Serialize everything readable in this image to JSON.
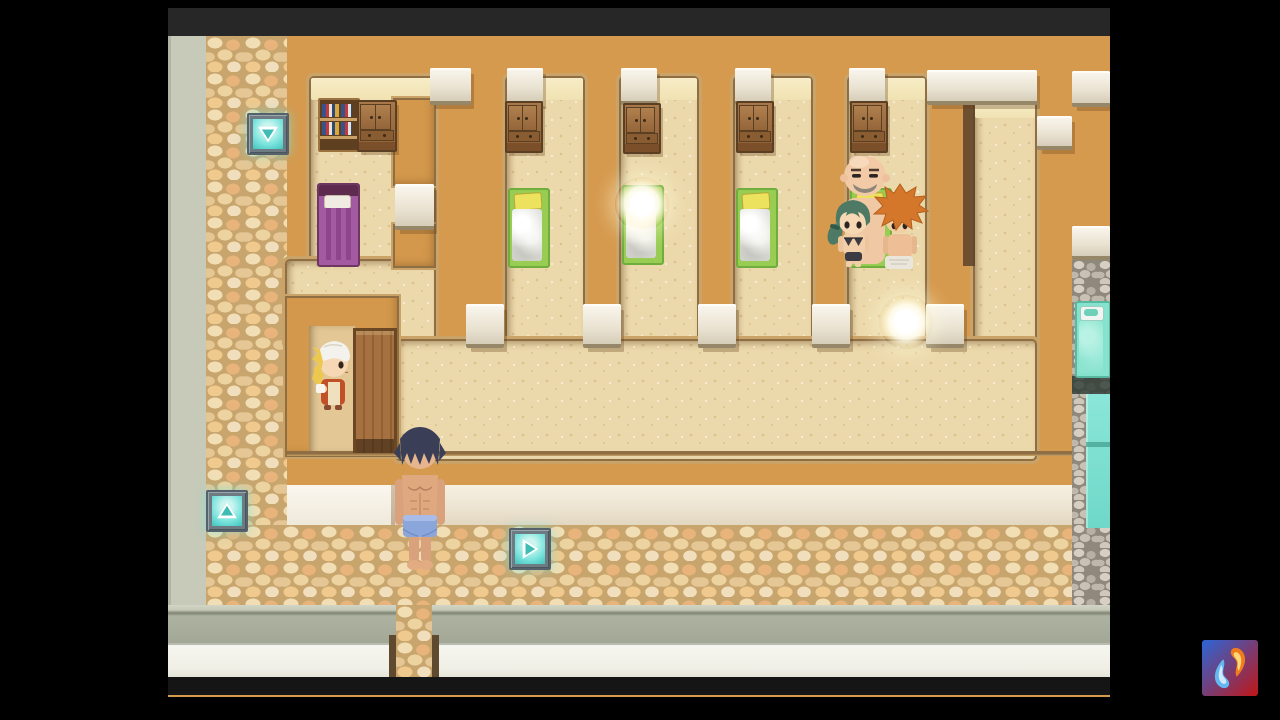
{
  "meta": {
    "style": "top-down pixel RPG scene",
    "scene_name": "dormitory-bathhouse interior",
    "visible_text": "none"
  },
  "frame": {
    "bg": "#000000",
    "game_x": 168,
    "game_y": 8,
    "game_w": 942,
    "game_h": 689,
    "top_bar_h": 28,
    "top_bar_color": "#272727"
  },
  "palette": {
    "wall": "#d69a4e",
    "floor": "#ecd9ab",
    "floor_lit": "#f4e8bf",
    "trim_dark": "#8f6e44",
    "trim_light": "#c9a368",
    "cream_band": "#ece3d1",
    "gray_wall": "#a3a795",
    "white_band": "#f2f2ea",
    "outer_strip": "#c7cab8",
    "water": "#7de0d2",
    "teleport_glow": "#7ce4dd",
    "dark_bottom": "#151515"
  },
  "layers": {
    "outer_strip": [
      0,
      0,
      38,
      569
    ],
    "cobble_dark": [
      38,
      0,
      20,
      566
    ],
    "cobble_path": [
      38,
      0,
      81,
      492
    ],
    "cobble_bottom": [
      38,
      489,
      904,
      80
    ],
    "floors": [
      {
        "name": "stall-1-floor",
        "r": [
          143,
          42,
          123,
          265
        ]
      },
      {
        "name": "stall-2-floor",
        "r": [
          339,
          42,
          76,
          265
        ]
      },
      {
        "name": "stall-3-floor",
        "r": [
          453,
          42,
          76,
          265
        ]
      },
      {
        "name": "stall-4-floor",
        "r": [
          567,
          42,
          76,
          265
        ]
      },
      {
        "name": "stall-5-floor",
        "r": [
          681,
          42,
          76,
          265
        ]
      },
      {
        "name": "right-corridor-floor",
        "r": [
          807,
          67,
          60,
          354
        ]
      },
      {
        "name": "hall-upper-left-floor",
        "r": [
          119,
          225,
          147,
          84
        ]
      },
      {
        "name": "main-hall-floor",
        "r": [
          229,
          305,
          638,
          118
        ]
      }
    ],
    "lit_strips": [
      [
        143,
        42,
        123,
        22
      ],
      [
        339,
        42,
        76,
        22
      ],
      [
        453,
        42,
        76,
        22
      ],
      [
        567,
        42,
        76,
        22
      ],
      [
        681,
        42,
        76,
        22
      ],
      [
        807,
        67,
        60,
        15
      ]
    ],
    "walls": [
      {
        "name": "stall1-pillar",
        "r": [
          227,
          64,
          39,
          84
        ]
      },
      {
        "name": "stall1-pillar-foot",
        "r": [
          227,
          190,
          39,
          40
        ]
      },
      {
        "name": "npc-alcove-wall",
        "r": [
          119,
          262,
          110,
          157
        ]
      }
    ],
    "shadow_strip": [
      795,
      64,
      12,
      166
    ],
    "alcove_floor": [
      141,
      290,
      46,
      127
    ],
    "caps": [
      [
        262,
        32,
        41,
        33
      ],
      [
        339,
        32,
        36,
        33
      ],
      [
        453,
        32,
        36,
        33
      ],
      [
        567,
        32,
        36,
        33
      ],
      [
        681,
        32,
        36,
        33
      ],
      [
        759,
        34,
        110,
        31
      ],
      [
        904,
        35,
        38,
        32
      ],
      [
        227,
        148,
        39,
        42
      ],
      [
        869,
        80,
        35,
        30
      ],
      [
        904,
        190,
        38,
        30
      ],
      [
        298,
        268,
        38,
        40
      ],
      [
        415,
        268,
        38,
        40
      ],
      [
        530,
        268,
        38,
        40
      ],
      [
        644,
        268,
        38,
        40
      ],
      [
        758,
        268,
        38,
        40
      ]
    ],
    "band_trim": [
      119,
      415,
      785,
      5
    ],
    "cream_band": [
      119,
      449,
      785,
      40
    ],
    "cream_cap": [
      119,
      449,
      104,
      40
    ],
    "gray_band": [
      0,
      569,
      942,
      38
    ],
    "white_band": [
      0,
      607,
      942,
      34
    ],
    "dark_strip": [
      0,
      641,
      942,
      18
    ],
    "gap_cobble": [
      228,
      569,
      36,
      72
    ],
    "gap_flanks": [
      [
        221,
        599,
        7,
        42
      ],
      [
        264,
        599,
        7,
        42
      ]
    ],
    "bath": {
      "column": [
        904,
        224,
        38,
        345
      ],
      "dark_band": [
        904,
        340,
        38,
        18
      ],
      "water": [
        918,
        358,
        24,
        134
      ],
      "divider": [
        918,
        406,
        24,
        5
      ]
    }
  },
  "furniture": [
    {
      "kind": "bookshelf",
      "name": "bookshelf",
      "r": [
        150,
        62,
        38,
        50
      ]
    },
    {
      "kind": "cabinet",
      "name": "wardrobe-cabinet",
      "r": [
        189,
        64,
        36,
        48
      ]
    },
    {
      "kind": "cabinet",
      "name": "wardrobe-cabinet",
      "r": [
        337,
        65,
        34,
        48
      ]
    },
    {
      "kind": "cabinet",
      "name": "wardrobe-cabinet",
      "r": [
        455,
        67,
        34,
        47
      ]
    },
    {
      "kind": "cabinet",
      "name": "wardrobe-cabinet",
      "r": [
        568,
        65,
        34,
        48
      ]
    },
    {
      "kind": "cabinet",
      "name": "wardrobe-cabinet",
      "r": [
        682,
        65,
        34,
        48
      ]
    },
    {
      "kind": "bed-purple",
      "name": "purple-bed",
      "r": [
        149,
        147,
        39,
        80
      ]
    },
    {
      "kind": "bed-green",
      "name": "green-bed",
      "r": [
        340,
        152,
        38,
        76
      ]
    },
    {
      "kind": "bed-green",
      "name": "green-bed",
      "r": [
        454,
        149,
        38,
        76
      ]
    },
    {
      "kind": "bed-green",
      "name": "green-bed",
      "r": [
        568,
        152,
        38,
        76
      ]
    },
    {
      "kind": "bed-green",
      "name": "green-bed",
      "r": [
        682,
        152,
        38,
        76
      ]
    },
    {
      "kind": "bed-teal",
      "name": "teal-bath-bed",
      "r": [
        907,
        265,
        32,
        73
      ]
    },
    {
      "kind": "door",
      "name": "wooden-door",
      "r": [
        185,
        292,
        38,
        122
      ]
    }
  ],
  "teleports": [
    {
      "direction": "down",
      "r": [
        79,
        77,
        38,
        38
      ]
    },
    {
      "direction": "up",
      "r": [
        38,
        454,
        38,
        38
      ]
    },
    {
      "direction": "right",
      "r": [
        341,
        492,
        38,
        38
      ]
    }
  ],
  "characters": [
    {
      "kind": "bald-man",
      "name": "npc-bald-man",
      "desc": "bald man with gray mustache",
      "r": [
        671,
        112,
        52,
        120
      ]
    },
    {
      "kind": "green-girl",
      "name": "npc-green-haired-girl",
      "desc": "green-haired woman in dark bikini",
      "r": [
        658,
        156,
        54,
        76
      ]
    },
    {
      "kind": "orange-guy",
      "name": "npc-orange-haired-man",
      "desc": "spiky orange-haired man with towel",
      "r": [
        703,
        146,
        58,
        88
      ]
    },
    {
      "kind": "towel-girl",
      "name": "npc-towel-girl",
      "desc": "blonde woman with white head towel, red outfit",
      "r": [
        136,
        299,
        56,
        78
      ]
    },
    {
      "kind": "player",
      "name": "player-character",
      "desc": "shirtless man, dark blue hair, light blue trunks",
      "r": [
        220,
        387,
        64,
        150
      ]
    }
  ],
  "effects": [
    {
      "kind": "glow-orb",
      "name": "glow-orb-on-bed",
      "r": [
        447,
        141,
        54,
        54
      ]
    },
    {
      "kind": "glow-orb",
      "name": "glow-orb-on-floor",
      "r": [
        711,
        259,
        54,
        54
      ]
    }
  ],
  "watermark": {
    "r": [
      1202,
      640,
      56,
      56
    ],
    "gradient": [
      "#2b66d8",
      "#c01616"
    ],
    "flame_blue": "#63b8f2",
    "flame_orange": "#f07c1e"
  }
}
